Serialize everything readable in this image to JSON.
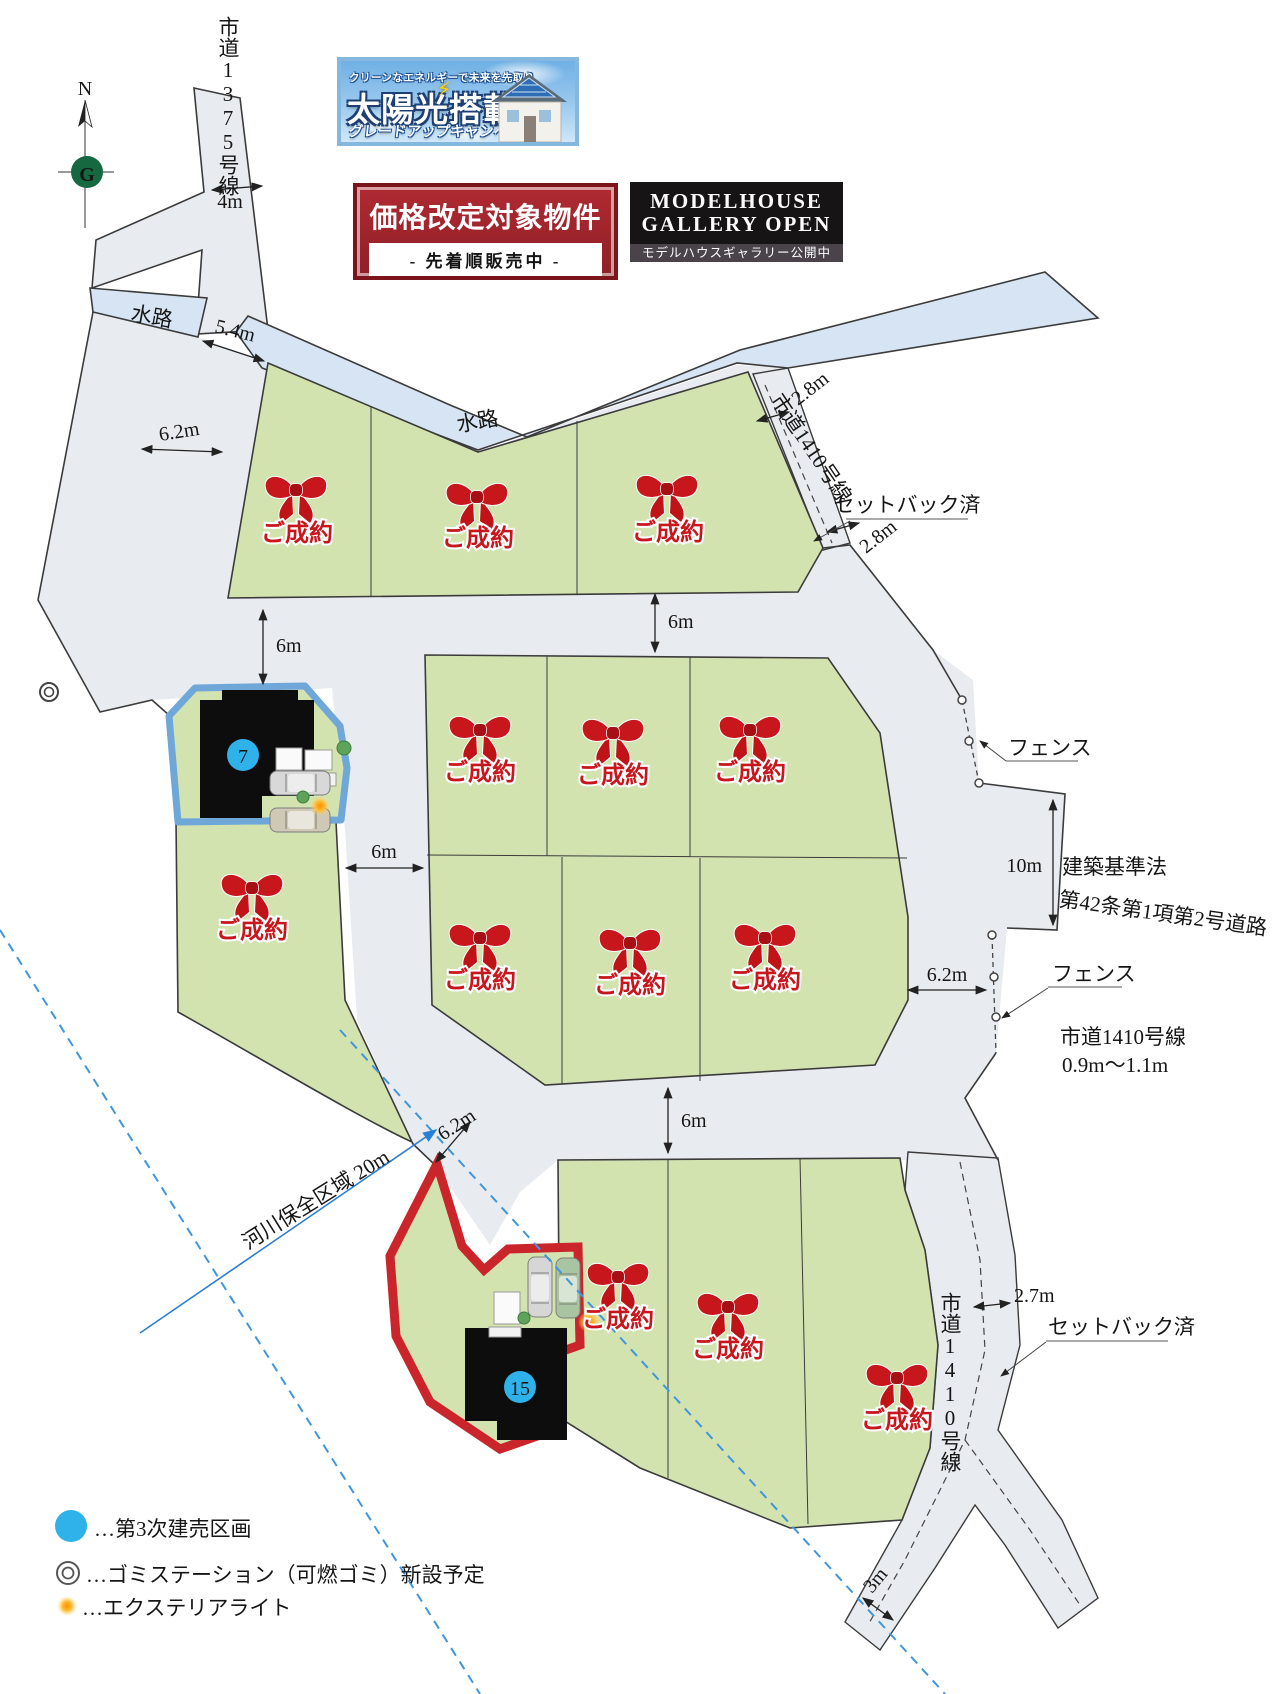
{
  "banners": {
    "solar": {
      "tagline": "クリーンなエネルギーで未来を先取り",
      "title": "太陽光搭載",
      "bolt": "⚡",
      "subtitle": "グレードアップキャンペーン"
    },
    "price": {
      "title": "価格改定対象物件",
      "subtitle": "- 先着順販売中 -"
    },
    "model": {
      "line1": "MODELHOUSE",
      "line2": "GALLERY OPEN",
      "subtitle": "モデルハウスギャラリー公開中"
    }
  },
  "compass": {
    "north": "N",
    "logo": "G"
  },
  "map": {
    "road_1375": "市道1375号線",
    "road_1410": "市道1410号線",
    "road_1410_width": "0.9m〜1.1m",
    "waterway": "水路",
    "setback": "セットバック済",
    "fence": "フェンス",
    "building_code_line1": "建築基準法",
    "building_code_line2": "第42条第1項第2号道路",
    "river_zone": "河川保全区域 20m",
    "sold": "ご成約",
    "lot7": "7",
    "lot15": "15",
    "dims": {
      "d4": "4m",
      "d54": "5.4m",
      "d62": "6.2m",
      "d28": "2.8m",
      "d6": "6m",
      "d10": "10m",
      "d27": "2.7m",
      "d3": "3m"
    }
  },
  "legend": {
    "phase": "…第3次建売区画",
    "garbage": "…ゴミステーション（可燃ゴミ）新設予定",
    "light": "…エクステリアライト"
  },
  "colors": {
    "road": "#e8ebef",
    "water": "#d6e4f3",
    "lot": "#d3e3b0",
    "accent_red": "#c8161d",
    "lot7_border": "#6ea7d8",
    "lot15_border": "#c9252b",
    "marker_blue": "#2fb1ea",
    "river_blue": "#1a73c4"
  }
}
